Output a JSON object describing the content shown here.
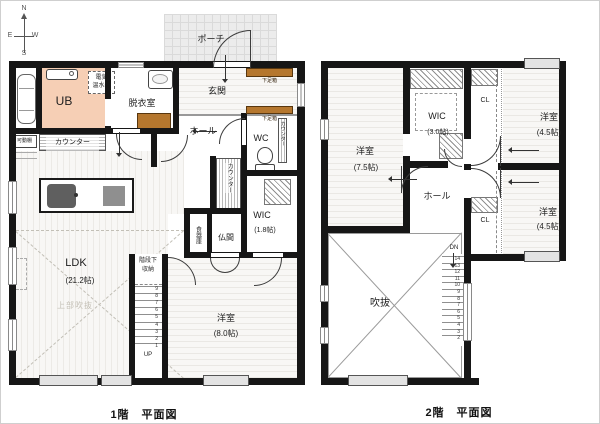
{
  "compass": {
    "n": "N",
    "e": "E",
    "w": "W",
    "s": "S"
  },
  "colors": {
    "wall": "#161616",
    "ub_fill": "#f6cfb5",
    "cabinet_fill": "#b5772e",
    "porch_fill": "#ececec"
  },
  "floor1": {
    "caption": "1階　平面図",
    "labels": {
      "porch": "ポーチ",
      "genkan": "玄関",
      "getabako": "下足箱",
      "ub": "UB",
      "datsuishitsu": "脱衣室",
      "denki_line1": "電気",
      "denki_line2": "温水器",
      "hall": "ホール",
      "wc": "WC",
      "counter": "カウンター",
      "kadou_dana": "可動棚",
      "ldk": "LDK",
      "ldk_size": "(21.2帖)",
      "joubu_fukinuke": "上部吹抜",
      "youshitsu": "洋室",
      "youshitsu_size": "(8.0帖)",
      "wic": "WIC",
      "wic_size": "(1.8帖)",
      "butsuma": "仏間",
      "shokkiko": "食器庫",
      "kaidanshita_line1": "階段下",
      "kaidanshita_line2": "収納",
      "up": "UP"
    },
    "stair_numbers": [
      "9",
      "8",
      "7",
      "6",
      "5",
      "4",
      "3",
      "2",
      "1"
    ]
  },
  "floor2": {
    "caption": "2階　平面図",
    "labels": {
      "youshitsu75": "洋室",
      "youshitsu75_size": "(7.5帖)",
      "wic": "WIC",
      "wic_size": "(3.0帖)",
      "youshitsu45": "洋室",
      "youshitsu45_size": "(4.5帖)",
      "hall": "ホール",
      "cl": "CL",
      "fukinuke": "吹抜",
      "dn": "DN"
    },
    "stair_numbers": [
      "14",
      "13",
      "12",
      "11",
      "10",
      "9",
      "8",
      "7",
      "6",
      "5",
      "4",
      "3",
      "2"
    ]
  }
}
